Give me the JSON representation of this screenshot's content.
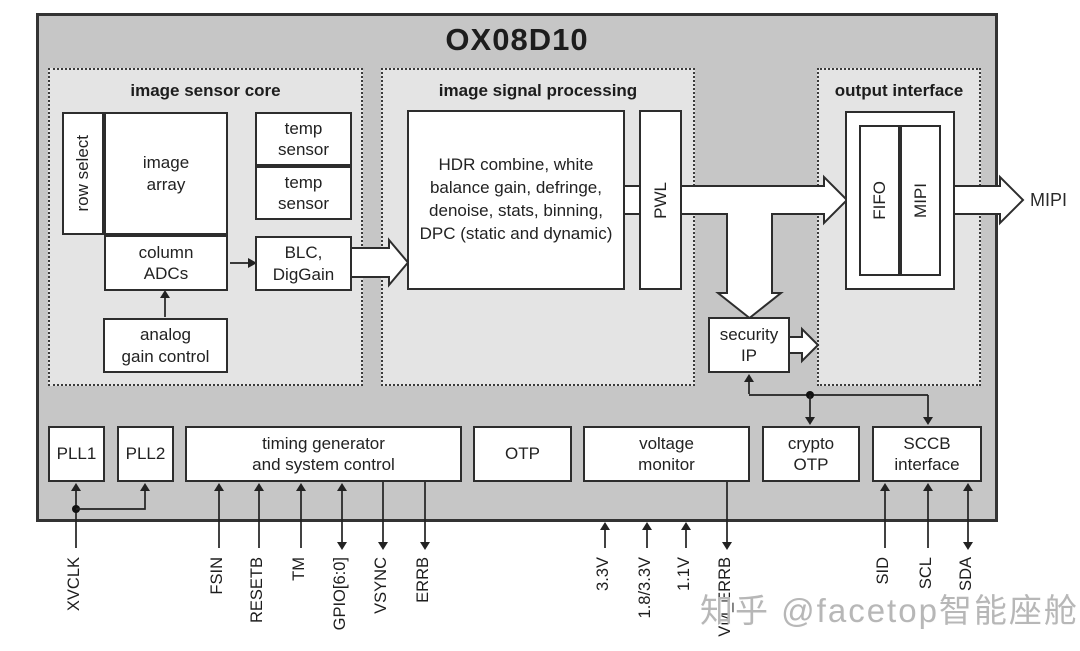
{
  "title": "OX08D10",
  "watermark": "知乎 @facetop智能座舱",
  "colors": {
    "chip_fill": "#c6c6c6",
    "section_fill": "#e4e4e4",
    "box_fill": "#ffffff",
    "line": "#2d2d2d"
  },
  "sections": {
    "core": {
      "label": "image sensor core"
    },
    "isp": {
      "label": "image signal processing"
    },
    "output": {
      "label": "output interface"
    }
  },
  "blocks": {
    "row_select": "row select",
    "image_array": "image\narray",
    "column_adcs": "column\nADCs",
    "temp_sensor_1": "temp\nsensor",
    "temp_sensor_2": "temp\nsensor",
    "blc_diggain": "BLC,\nDigGain",
    "analog_gain_control": "analog\ngain control",
    "isp_pipeline": "HDR combine, white\nbalance gain, defringe,\ndenoise, stats, binning,\nDPC (static and dynamic)",
    "pwl": "PWL",
    "fifo": "FIFO",
    "mipi": "MIPI",
    "security_ip": "security\nIP",
    "pll1": "PLL1",
    "pll2": "PLL2",
    "timing_generator": "timing generator\nand system control",
    "otp": "OTP",
    "voltage_monitor": "voltage\nmonitor",
    "crypto_otp": "crypto\nOTP",
    "sccb_interface": "SCCB\ninterface"
  },
  "outputs": {
    "mipi_bus_label": "MIPI"
  },
  "pins": {
    "left": [
      {
        "label": "XVCLK",
        "direction": "in"
      },
      {
        "label": "FSIN",
        "direction": "in"
      },
      {
        "label": "RESETB",
        "direction": "in"
      },
      {
        "label": "TM",
        "direction": "in"
      },
      {
        "label": "GPIO[6:0]",
        "direction": "bidir"
      },
      {
        "label": "VSYNC",
        "direction": "out"
      },
      {
        "label": "ERRB",
        "direction": "out"
      }
    ],
    "right": [
      {
        "label": "3.3V",
        "direction": "in"
      },
      {
        "label": "1.8/3.3V",
        "direction": "in"
      },
      {
        "label": "1.1V",
        "direction": "in"
      },
      {
        "label": "VM_ERRB",
        "direction": "out"
      },
      {
        "label": "SID",
        "direction": "in"
      },
      {
        "label": "SCL",
        "direction": "in"
      },
      {
        "label": "SDA",
        "direction": "bidir"
      }
    ]
  }
}
